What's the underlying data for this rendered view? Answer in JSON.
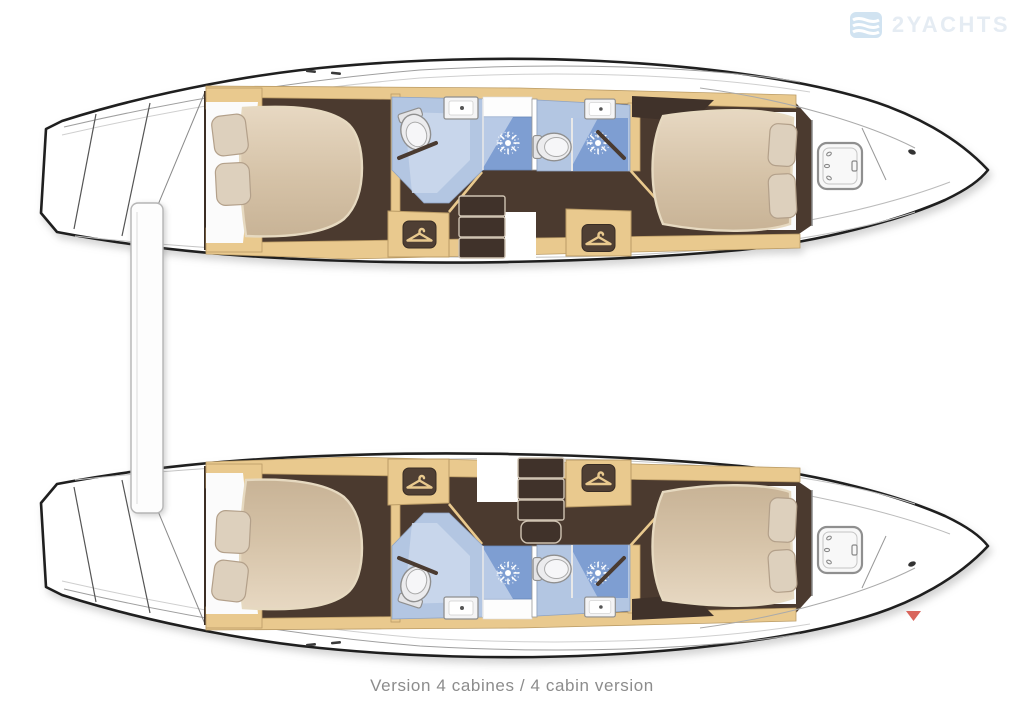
{
  "caption": {
    "text": "Version 4 cabines / 4 cabin version"
  },
  "watermark": {
    "brand": "2YACHTS"
  },
  "marker": {
    "name": "red-triangle-marker",
    "color": "#d9655c"
  },
  "colors": {
    "outline": "#1f1f1f",
    "hull": "#ffffff",
    "deck_line": "#a8a8a8",
    "floor": "#4b3a2f",
    "floor_dark": "#40322a",
    "wood": "#e9c98e",
    "wood_edge": "#bb9c66",
    "bed": "#d8c5ab",
    "bed_edge": "#e6d9c0",
    "pillow": "#ddd0bd",
    "bath": "#b3c6e2",
    "bath_light": "#cbd8ec",
    "shower": "#7e9ed2",
    "fixture": "#f4f4f5",
    "fixture_edge": "#8f8f8f",
    "caption_text": "#8c8c8c",
    "watermark_text": "#e4ebf3",
    "watermark_logo": "#cfe2f1"
  },
  "floorplan": {
    "vessel": "catamaran",
    "layout": "4 cabins / 4 cabines",
    "hulls": [
      {
        "name": "hull-top",
        "cabins": [
          "aft-double-cabin",
          "forward-double-cabin"
        ],
        "bathrooms": 2,
        "fixtures": [
          "double-bed",
          "pillows",
          "toilet",
          "washbasin",
          "shower",
          "wardrobe-hanger",
          "companionway-steps",
          "deck-hatch"
        ]
      },
      {
        "name": "hull-bottom",
        "cabins": [
          "aft-double-cabin",
          "forward-double-cabin"
        ],
        "bathrooms": 2,
        "fixtures": [
          "double-bed",
          "pillows",
          "toilet",
          "washbasin",
          "shower",
          "wardrobe-hanger",
          "companionway-steps",
          "deck-hatch"
        ]
      }
    ]
  }
}
